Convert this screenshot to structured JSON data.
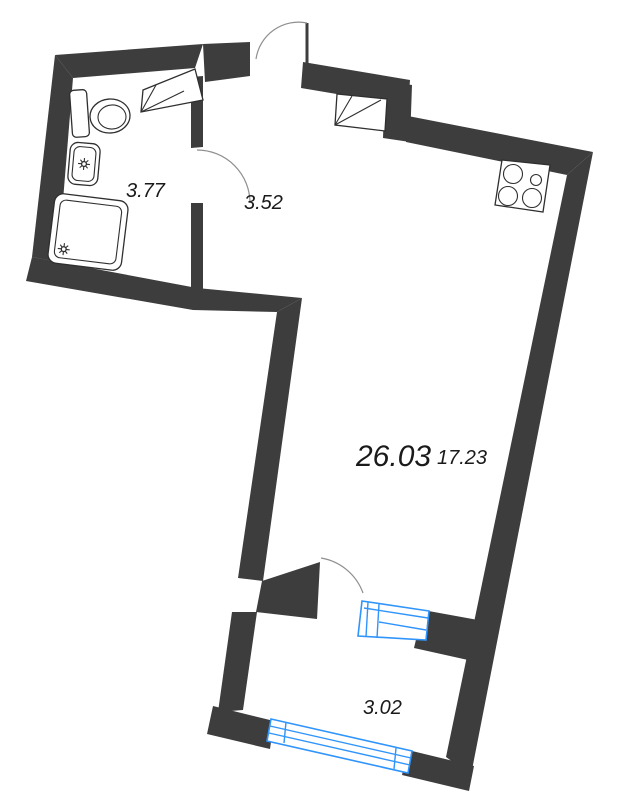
{
  "plan": {
    "type": "apartment-floor-plan",
    "rooms": {
      "bathroom": {
        "name": "bathroom",
        "area": "3.77"
      },
      "hallway": {
        "name": "hallway",
        "area": "3.52"
      },
      "total": {
        "name": "total-area",
        "area": "26.03"
      },
      "living": {
        "name": "living-room",
        "area": "17.23"
      },
      "balcony": {
        "name": "balcony",
        "area": "3.02"
      }
    },
    "fixtures": [
      "toilet",
      "sink",
      "shower-cabin",
      "counter-shelf",
      "vent-shaft",
      "stove"
    ],
    "doors": [
      "entrance-door",
      "bathroom-door",
      "balcony-door"
    ],
    "windows": [
      "balcony-door-window-unit",
      "balcony-outer-window"
    ],
    "colors": {
      "wall": "#3d3d3d",
      "window": "#2f94fc",
      "fixture_line": "#2f2f2f",
      "door_arc": "#8f8f8f",
      "label": "#1a1a1a",
      "background": "#ffffff"
    }
  }
}
